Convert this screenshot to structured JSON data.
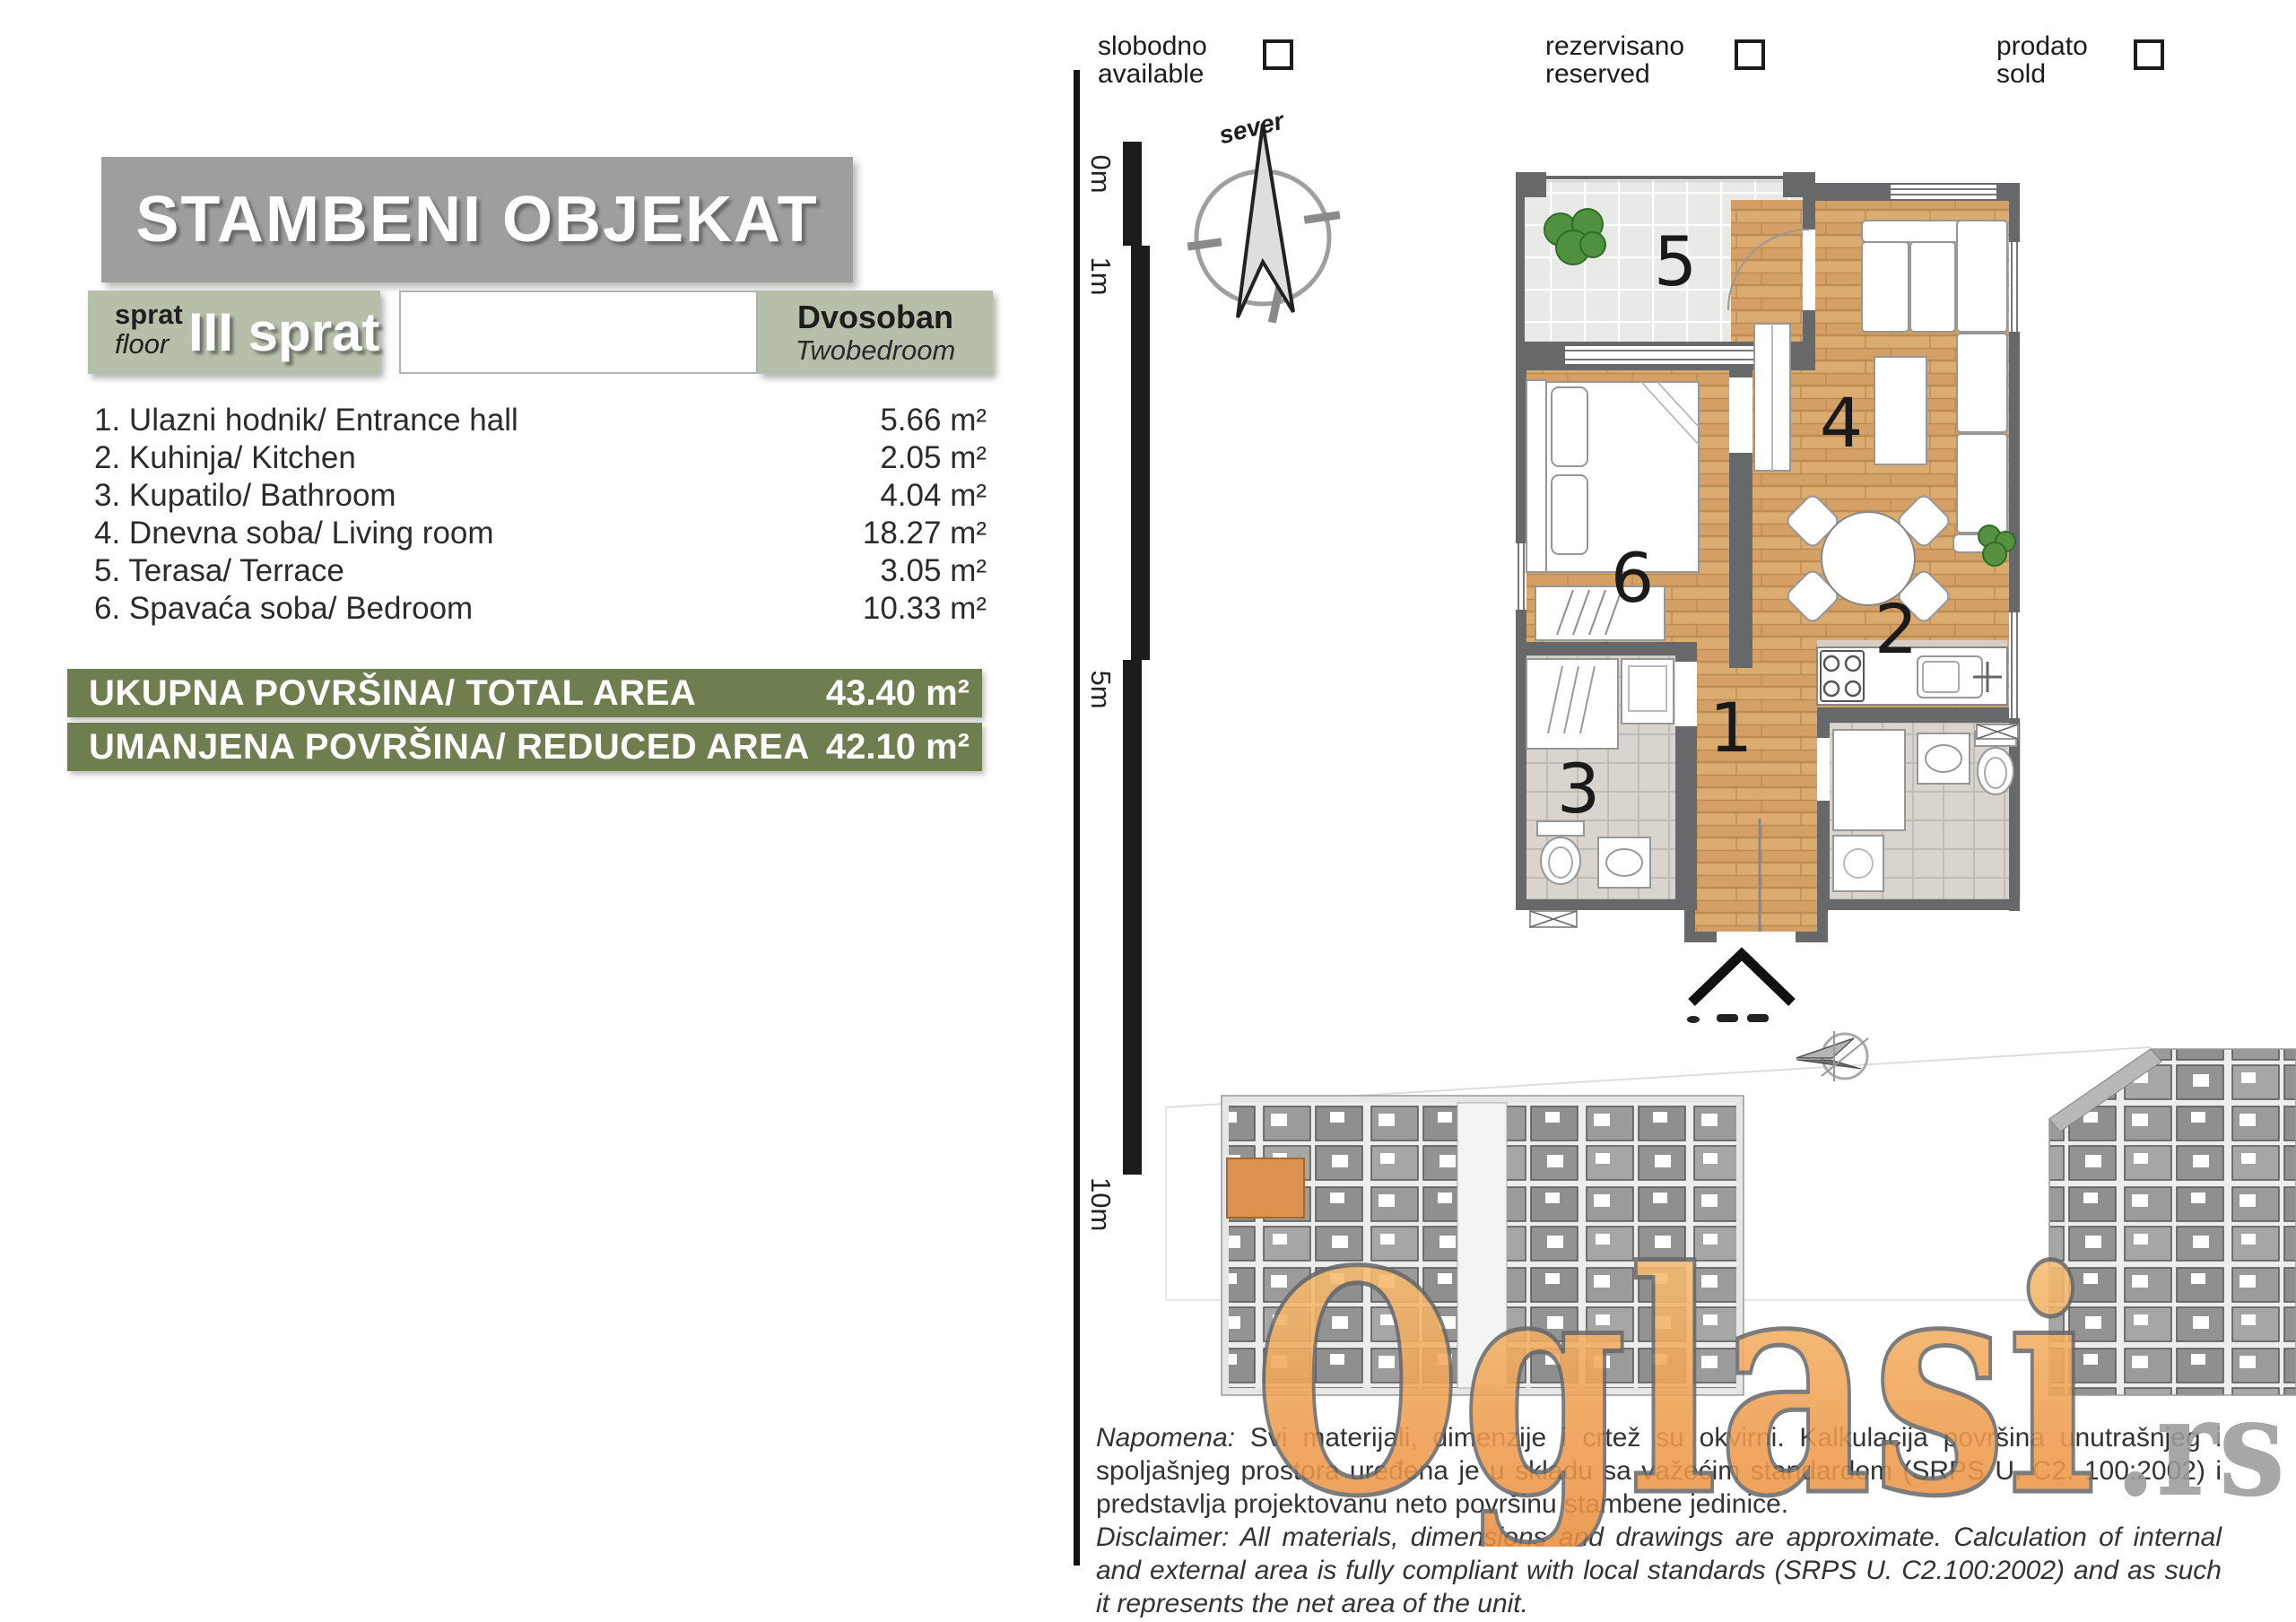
{
  "header": {
    "title": "STAMBENI OBJEKAT"
  },
  "floor_box": {
    "label_sr": "sprat",
    "label_en": "floor",
    "value": "III sprat"
  },
  "unit_type": {
    "sr": "Dvosoban",
    "en": "Twobedroom"
  },
  "rooms": [
    {
      "label": "1. Ulazni hodnik/ Entrance hall",
      "area": "5.66 m²"
    },
    {
      "label": "2. Kuhinja/ Kitchen",
      "area": "2.05 m²"
    },
    {
      "label": "3. Kupatilo/ Bathroom",
      "area": "4.04 m²"
    },
    {
      "label": "4. Dnevna soba/ Living room",
      "area": "18.27 m²"
    },
    {
      "label": "5. Terasa/ Terrace",
      "area": "3.05 m²"
    },
    {
      "label": "6. Spavaća soba/ Bedroom",
      "area": "10.33 m²"
    }
  ],
  "totals": [
    {
      "label": "UKUPNA POVRŠINA/ TOTAL AREA",
      "value": "43.40 m²"
    },
    {
      "label": "UMANJENA POVRŠINA/ REDUCED AREA",
      "value": "42.10 m²"
    }
  ],
  "legend": {
    "items": [
      {
        "sr": "slobodno",
        "en": "available"
      },
      {
        "sr": "rezervisano",
        "en": "reserved"
      },
      {
        "sr": "prodato",
        "en": "sold"
      }
    ]
  },
  "compass": {
    "label": "sever"
  },
  "scale_bar": {
    "labels": [
      "0m",
      "1m",
      "5m",
      "10m"
    ]
  },
  "floor_plan": {
    "room_numbers": {
      "hall": "1",
      "kitchen": "2",
      "bathroom": "3",
      "living": "4",
      "terrace": "5",
      "bedroom": "6"
    }
  },
  "watermark": {
    "brand": "Oglasi",
    "tld": ".rs"
  },
  "disclaimer": {
    "sr_lead": "Napomena:",
    "sr_body": " Svi materijali, dimenzije i crtež su okvirni. Kalkulacija površina unutrašnjeg i spoljašnjeg prostora uređena je u skladu sa važećim standardom (SRPS U. C2. 100:2002) i predstavlja projektovanu neto površinu stambene jedinice.",
    "en_lead": "Disclaimer:",
    "en_body": " All materials, dimensions and drawings are approximate. Calculation of internal and external area is fully compliant with local standards (SRPS U. C2.100:2002) and as such it represents the net area of the unit."
  },
  "colors": {
    "title_gray": "#9e9e9c",
    "sage": "#b6bfa9",
    "accent_olive": "#6e7e4f",
    "watermark_orange": "#ee9a4d",
    "wood": "#d9a76c"
  }
}
